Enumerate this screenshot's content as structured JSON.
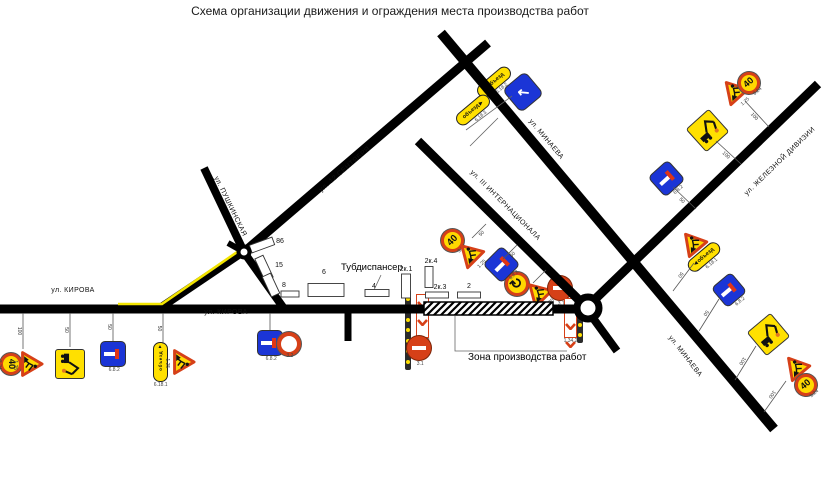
{
  "title": "Схема организации движения и ограждения места производства работ",
  "colors": {
    "road": "#000000",
    "route_yellow": "#f2e400",
    "sign_yellow": "#ffd900",
    "sign_red": "#d64018",
    "sign_blue": "#1b35d6"
  },
  "work_zone": {
    "x": 424,
    "y": 302,
    "w": 129,
    "h": 13,
    "label": "Зона производства работ",
    "label_x": 468,
    "label_y": 352,
    "leader": "455,316 455,351 567,351"
  },
  "tub": {
    "text": "Тубдиспансер",
    "x": 341,
    "y": 262,
    "leader": "381,275 374,290"
  },
  "streets": [
    {
      "text": "ул. КИРОВА",
      "x": 73,
      "y": 292,
      "rot": 0
    },
    {
      "text": "ул. КИРОВА",
      "x": 226,
      "y": 314,
      "rot": 0
    },
    {
      "text": "ул. ПУШКИНСКАЯ",
      "x": 230,
      "y": 208,
      "rot": 64
    },
    {
      "text": "ул. 12 СЕНТЯБРЯ",
      "x": 345,
      "y": 171,
      "rot": -41
    },
    {
      "text": "ул. МИНАЕВА",
      "x": 546,
      "y": 141,
      "rot": 50
    },
    {
      "text": "ул. III ИНТЕРНАЦИОНАЛА",
      "x": 505,
      "y": 207,
      "rot": 45
    },
    {
      "text": "ул. ЖЕЛЕЗНОЙ ДИВИЗИИ",
      "x": 780,
      "y": 163,
      "rot": -44
    },
    {
      "text": "ул. МИНАЕВА",
      "x": 685,
      "y": 358,
      "rot": 52
    }
  ],
  "roads": [
    {
      "x1": 0,
      "y1": 309,
      "x2": 426,
      "y2": 309,
      "w": 9
    },
    {
      "x1": 552,
      "y1": 309,
      "x2": 580,
      "y2": 309,
      "w": 9
    },
    {
      "x1": 160,
      "y1": 308,
      "x2": 246,
      "y2": 250,
      "w": 8
    },
    {
      "x1": 243,
      "y1": 251,
      "x2": 285,
      "y2": 310,
      "w": 8
    },
    {
      "x1": 244,
      "y1": 252,
      "x2": 204,
      "y2": 168,
      "w": 8
    },
    {
      "x1": 228,
      "y1": 243,
      "x2": 244,
      "y2": 252,
      "w": 6
    },
    {
      "x1": 244,
      "y1": 252,
      "x2": 488,
      "y2": 43,
      "w": 9
    },
    {
      "x1": 441,
      "y1": 33,
      "x2": 774,
      "y2": 429,
      "w": 10
    },
    {
      "x1": 418,
      "y1": 141,
      "x2": 584,
      "y2": 305,
      "w": 9
    },
    {
      "x1": 588,
      "y1": 306,
      "x2": 818,
      "y2": 84,
      "w": 9
    },
    {
      "x1": 590,
      "y1": 314,
      "x2": 617,
      "y2": 351,
      "w": 8
    },
    {
      "x1": 348,
      "y1": 313,
      "x2": 348,
      "y2": 341,
      "w": 7
    }
  ],
  "detour_route_polyline": "118,304 162,304 243,248",
  "junctions": [
    {
      "x": 244,
      "y": 252,
      "r": 5.5,
      "sw": 4
    },
    {
      "x": 588,
      "y": 308,
      "r": 11,
      "sw": 7
    }
  ],
  "buildings": [
    {
      "label": "86",
      "x": 262,
      "y": 245,
      "w": 24,
      "h": 8,
      "rot": -20,
      "lx": 280,
      "ly": 243
    },
    {
      "label": "15",
      "x": 264,
      "y": 268,
      "w": 9,
      "h": 24,
      "rot": -25,
      "lx": 279,
      "ly": 267
    },
    {
      "label": "8",
      "x": 271,
      "y": 285,
      "w": 9,
      "h": 22,
      "rot": -25,
      "lx": 284,
      "ly": 287
    },
    {
      "label": "",
      "x": 290,
      "y": 294,
      "w": 18,
      "h": 6,
      "rot": 0,
      "lx": 0,
      "ly": 0
    },
    {
      "label": "6",
      "x": 326,
      "y": 290,
      "w": 36,
      "h": 13,
      "rot": 0,
      "lx": 324,
      "ly": 274
    },
    {
      "label": "4",
      "x": 377,
      "y": 293,
      "w": 24,
      "h": 7,
      "rot": 0,
      "lx": 374,
      "ly": 288
    },
    {
      "label": "2к.1",
      "x": 406,
      "y": 286,
      "w": 9,
      "h": 24,
      "rot": 0,
      "lx": 406,
      "ly": 271
    },
    {
      "label": "2к.4",
      "x": 429,
      "y": 277,
      "w": 8,
      "h": 21,
      "rot": 0,
      "lx": 431,
      "ly": 263
    },
    {
      "label": "2к.3",
      "x": 437,
      "y": 295,
      "w": 23,
      "h": 6,
      "rot": 0,
      "lx": 440,
      "ly": 289
    },
    {
      "label": "2",
      "x": 469,
      "y": 295,
      "w": 23,
      "h": 6,
      "rot": 0,
      "lx": 469,
      "ly": 288
    }
  ],
  "posts": [
    {
      "x1": 23,
      "y1": 313,
      "x2": 23,
      "y2": 349,
      "label": "100"
    },
    {
      "x1": 70,
      "y1": 313,
      "x2": 70,
      "y2": 347,
      "label": "50"
    },
    {
      "x1": 113,
      "y1": 313,
      "x2": 113,
      "y2": 341,
      "label": "50"
    },
    {
      "x1": 163,
      "y1": 313,
      "x2": 163,
      "y2": 344,
      "label": "50"
    },
    {
      "x1": 270,
      "y1": 313,
      "x2": 270,
      "y2": 330,
      "label": ""
    },
    {
      "x1": 472,
      "y1": 238,
      "x2": 486,
      "y2": 224,
      "label": "50"
    },
    {
      "x1": 503,
      "y1": 259,
      "x2": 517,
      "y2": 245,
      "label": "50"
    },
    {
      "x1": 533,
      "y1": 283,
      "x2": 546,
      "y2": 270,
      "label": ""
    },
    {
      "x1": 745,
      "y1": 101,
      "x2": 769,
      "y2": 127,
      "label": "100"
    },
    {
      "x1": 716,
      "y1": 141,
      "x2": 741,
      "y2": 164,
      "label": "100"
    },
    {
      "x1": 673,
      "y1": 187,
      "x2": 696,
      "y2": 209,
      "label": "50"
    },
    {
      "x1": 694,
      "y1": 263,
      "x2": 673,
      "y2": 291,
      "label": "50"
    },
    {
      "x1": 719,
      "y1": 299,
      "x2": 699,
      "y2": 331,
      "label": "50"
    },
    {
      "x1": 756,
      "y1": 346,
      "x2": 735,
      "y2": 380,
      "label": "100"
    },
    {
      "x1": 786,
      "y1": 381,
      "x2": 764,
      "y2": 412,
      "label": "100"
    }
  ],
  "leaders": [
    "381,275 374,290",
    "455,316 455,351 567,351",
    "512,96 466,130",
    "498,118 470,146"
  ],
  "signs": [
    {
      "type": "limit40",
      "x": 11,
      "y": 364,
      "size": 22,
      "rot": 90,
      "text": "40",
      "code": "3.24"
    },
    {
      "type": "works",
      "x": 32,
      "y": 364,
      "size": 26,
      "rot": 90,
      "code": "1.25"
    },
    {
      "type": "excavator",
      "x": 70,
      "y": 364,
      "size": 30,
      "rot": 90,
      "code": ""
    },
    {
      "type": "deadend",
      "x": 113,
      "y": 354,
      "size": 24,
      "rot": 0,
      "code": "6.8.2"
    },
    {
      "type": "detour-v",
      "x": 160,
      "y": 362,
      "w": 15,
      "h": 40,
      "rot": 0,
      "text": "объезд",
      "arrow": "▲",
      "code": "6.18.1"
    },
    {
      "type": "works",
      "x": 184,
      "y": 362,
      "size": 26,
      "rot": 90,
      "code": "1.25"
    },
    {
      "type": "deadend",
      "x": 270,
      "y": 343,
      "size": 24,
      "rot": 0,
      "code": "6.8.2"
    },
    {
      "type": "ring",
      "x": 289,
      "y": 344,
      "size": 24,
      "rot": 0,
      "code": "3.2"
    },
    {
      "type": "barrier",
      "x": 408,
      "y": 330,
      "w": 6,
      "h": 80,
      "rot": 0
    },
    {
      "type": "chevrons",
      "x": 422,
      "y": 316,
      "w": 13,
      "h": 44,
      "rot": 0,
      "code": "1.34.2"
    },
    {
      "type": "brick",
      "x": 419,
      "y": 348,
      "size": 24,
      "rot": 0,
      "code": "3.1"
    },
    {
      "type": "circular",
      "x": 517,
      "y": 284,
      "size": 24,
      "rot": -45,
      "text": "↻"
    },
    {
      "type": "works",
      "x": 537,
      "y": 292,
      "size": 26,
      "rot": -45,
      "code": "1.25"
    },
    {
      "type": "brick",
      "x": 560,
      "y": 288,
      "size": 24,
      "rot": 0,
      "code": "3.1"
    },
    {
      "type": "chevrons",
      "x": 570,
      "y": 318,
      "w": 13,
      "h": 40,
      "rot": 0,
      "code": "1.34.2"
    },
    {
      "type": "barrier",
      "x": 580,
      "y": 320,
      "w": 6,
      "h": 46,
      "rot": 0
    },
    {
      "type": "limit40",
      "x": 452,
      "y": 240,
      "size": 23,
      "rot": -45,
      "text": "40",
      "code": "3.24"
    },
    {
      "type": "works",
      "x": 469,
      "y": 253,
      "size": 26,
      "rot": -45,
      "code": "1.25"
    },
    {
      "type": "deadend",
      "x": 501,
      "y": 264,
      "size": 25,
      "rot": -45,
      "code": "6.8.2"
    },
    {
      "type": "detour-h",
      "x": 494,
      "y": 82,
      "w": 40,
      "h": 14,
      "rot": -40,
      "text": "объезд",
      "arrow": "◀",
      "side": "left",
      "code": "6.18.2"
    },
    {
      "type": "detour-h",
      "x": 473,
      "y": 110,
      "w": 40,
      "h": 14,
      "rot": -40,
      "text": "объезд",
      "arrow": "▶",
      "side": "right",
      "code": "6.18.3"
    },
    {
      "type": "detour-blue",
      "x": 523,
      "y": 92,
      "size": 28,
      "rot": -40,
      "text": "↖"
    },
    {
      "type": "works",
      "x": 733,
      "y": 90,
      "size": 26,
      "rot": -42,
      "code": "1.25"
    },
    {
      "type": "limit40",
      "x": 749,
      "y": 83,
      "size": 22,
      "rot": -42,
      "text": "40",
      "code": "3.24"
    },
    {
      "type": "excavator",
      "x": 707,
      "y": 130,
      "size": 31,
      "rot": -42
    },
    {
      "type": "deadend",
      "x": 666,
      "y": 178,
      "size": 25,
      "rot": -42,
      "code": "6.8.2"
    },
    {
      "type": "works",
      "x": 692,
      "y": 242,
      "size": 26,
      "rot": -40,
      "code": "1.25"
    },
    {
      "type": "detour-h",
      "x": 704,
      "y": 257,
      "w": 38,
      "h": 14,
      "rot": -40,
      "text": "объезд",
      "arrow": "◀",
      "side": "left",
      "code": "6.18.1"
    },
    {
      "type": "deadend",
      "x": 729,
      "y": 290,
      "size": 24,
      "rot": -40,
      "code": "6.8.2"
    },
    {
      "type": "excavator",
      "x": 768,
      "y": 334,
      "size": 31,
      "rot": -40
    },
    {
      "type": "works",
      "x": 795,
      "y": 366,
      "size": 26,
      "rot": -40,
      "code": "1.25"
    },
    {
      "type": "limit40",
      "x": 806,
      "y": 385,
      "size": 22,
      "rot": -40,
      "text": "40",
      "code": "3.24"
    }
  ]
}
